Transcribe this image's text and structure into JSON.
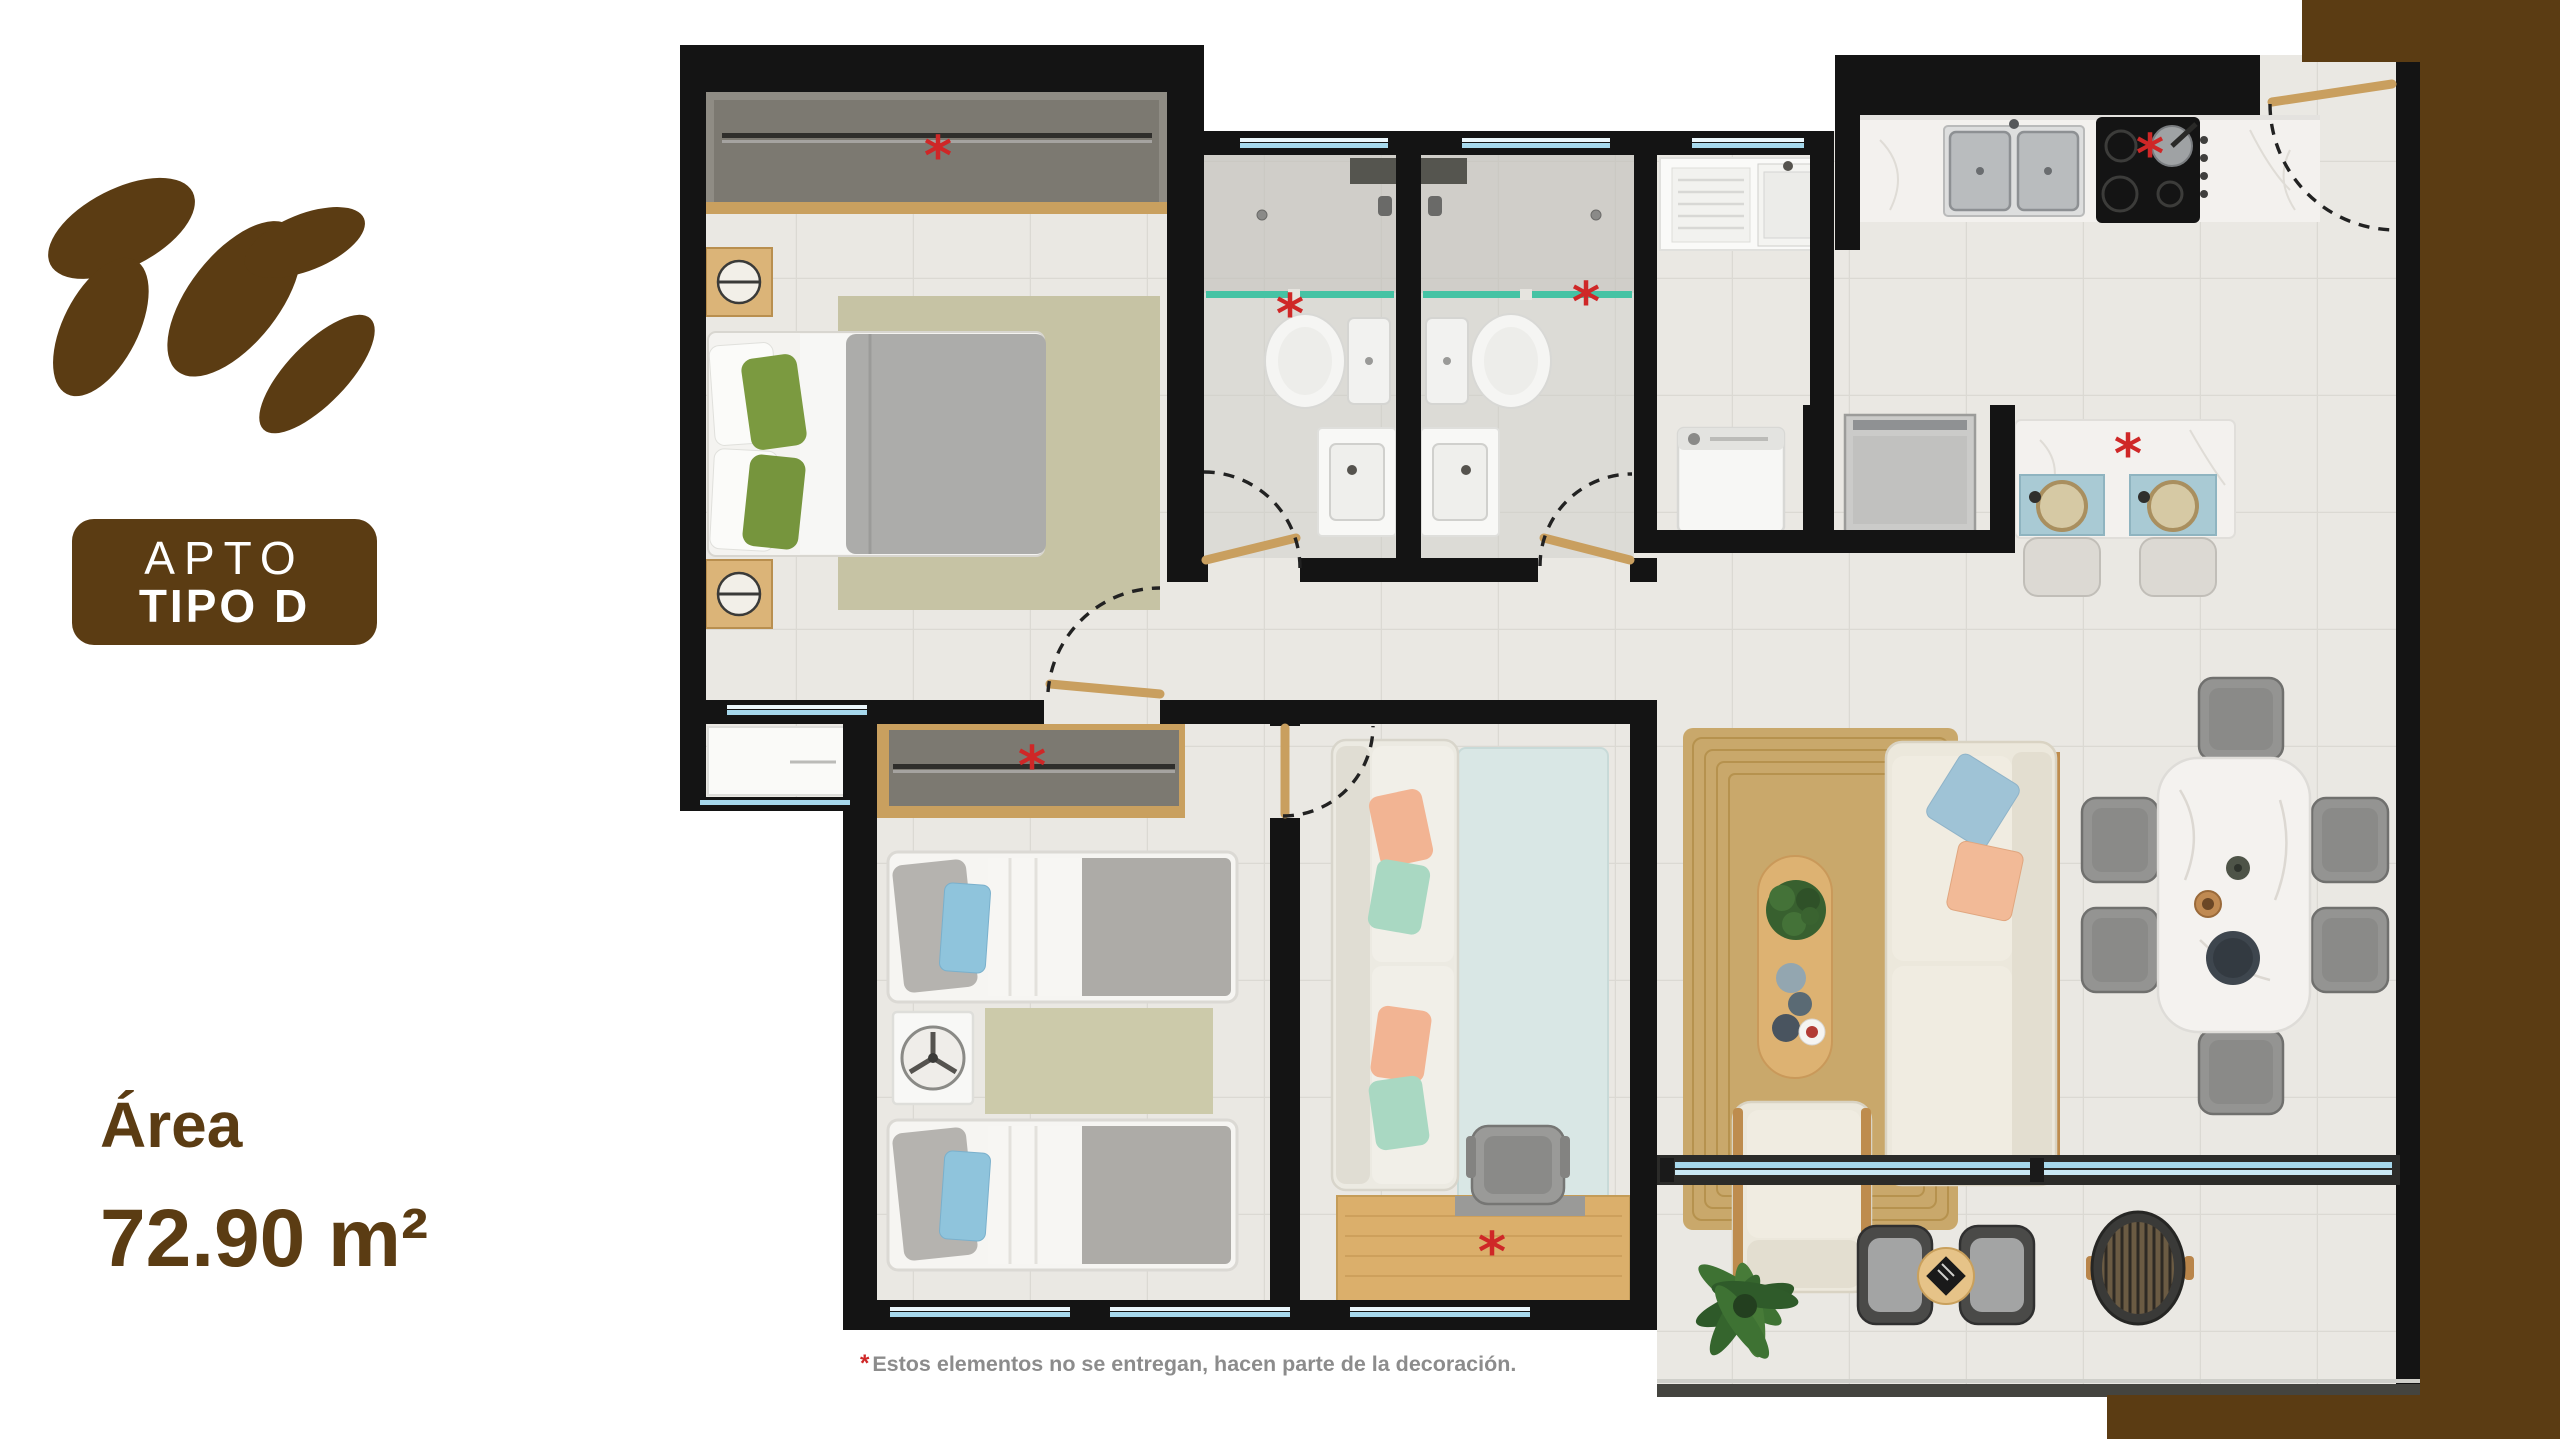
{
  "page": {
    "width": 2560,
    "height": 1439,
    "background": "#FFFFFF"
  },
  "branding": {
    "logo": "leaf-cluster",
    "brand_brown": "#5B3C13"
  },
  "unit_badge": {
    "line1": "APTO",
    "line2": "TIPO D",
    "bg": "#5B3C13",
    "text_color": "#FFFFFF"
  },
  "area": {
    "label": "Área",
    "value": "72.90 m²",
    "color": "#5B3C13"
  },
  "disclaimer": {
    "marker": "*",
    "marker_color": "#CF2727",
    "text": "Estos elementos no se entregan, hacen parte de la decoración.",
    "text_color": "#8C8C8C"
  },
  "floorplan": {
    "wall_color": "#141414",
    "floor_color": "#EAE8E3",
    "glass_color": "#A6D8EC",
    "shower_glass_color": "#45C3A4",
    "wood_color": "#C99F5F",
    "decor_marker": "*",
    "decor_marker_color": "#CF2727",
    "rooms": [
      {
        "name": "master-bedroom",
        "furniture": [
          "double-bed",
          "nightstands-with-lamps",
          "sliding-closet",
          "rug",
          "dresser-bay"
        ]
      },
      {
        "name": "bathroom-1",
        "furniture": [
          "toilet",
          "vanity",
          "shower-with-glass"
        ]
      },
      {
        "name": "bathroom-2",
        "furniture": [
          "toilet",
          "vanity",
          "shower-with-glass"
        ]
      },
      {
        "name": "utility-room",
        "furniture": [
          "laundry-sink",
          "washing-machine",
          "appliance-nook"
        ]
      },
      {
        "name": "kitchen",
        "furniture": [
          "double-sink",
          "cooktop",
          "marble-counter",
          "island-with-stools",
          "entry-door"
        ]
      },
      {
        "name": "bedroom-2",
        "furniture": [
          "single-bed",
          "single-bed",
          "closet",
          "fan-nightstand",
          "rug",
          "windows"
        ]
      },
      {
        "name": "study",
        "furniture": [
          "sofa",
          "blue-rug",
          "wood-desk",
          "desk-chair"
        ]
      },
      {
        "name": "living-room",
        "furniture": [
          "sofa",
          "armchair",
          "oval-coffee-table",
          "jute-rug"
        ]
      },
      {
        "name": "dining",
        "furniture": [
          "marble-table",
          "six-chairs"
        ]
      },
      {
        "name": "balcony",
        "furniture": [
          "plant",
          "two-rattan-chairs",
          "side-table",
          "round-woven-table",
          "sliding-window"
        ]
      }
    ],
    "decor_marker_locations": [
      "master-closet",
      "bedroom2-closet",
      "bathroom-1",
      "bathroom-2",
      "cooktop",
      "island",
      "desk"
    ]
  }
}
